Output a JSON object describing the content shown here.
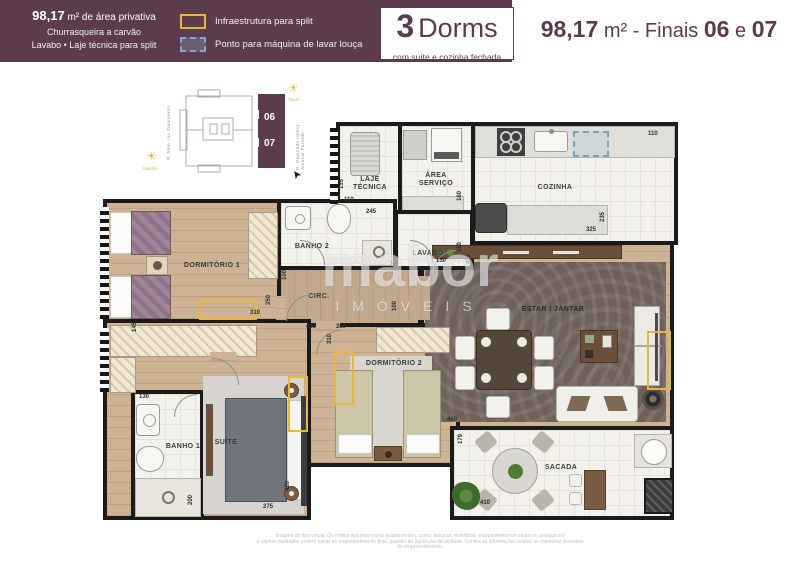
{
  "header": {
    "left": {
      "line1_bold": "98,17",
      "line1_rest": " m² de área privativa",
      "line2": "Churrasqueira a carvão",
      "line3": "Lavabo • Laje técnica para split"
    },
    "legend": [
      {
        "label": "Infraestrutura para split"
      },
      {
        "label": "Ponto para máquina de lavar louça"
      }
    ],
    "dorms_box": {
      "num": "3",
      "word": "Dorms",
      "sub": "com suíte e cozinha fechada"
    },
    "right": {
      "area": "98,17",
      "unit": "m²",
      "middle": " - Finais ",
      "final1": "06",
      "conj": " e ",
      "final2": "07"
    }
  },
  "key_diagram": {
    "unit_top": "06",
    "unit_bottom": "07",
    "sun_afternoon": "Tarde",
    "sun_morning": "Manhã",
    "street_left": "R. Mon. Ivo Zanlorenzi",
    "street_right": "R. Deputado Heitor Alencar Furtado"
  },
  "watermark": {
    "name": "mabor",
    "subtitle": "IMÓVEIS"
  },
  "plan": {
    "rooms": {
      "laje_l1": "LAJE",
      "laje_l2": "TÉCNICA",
      "area_l1": "ÁREA",
      "area_l2": "SERVIÇO",
      "cozinha": "COZINHA",
      "banho2": "BANHO 2",
      "lavabo": "LAVABO",
      "circ": "CIRC.",
      "dorm1": "DORMITÓRIO 1",
      "dorm2": "DORMITÓRIO 2",
      "suite": "SUÍTE",
      "banho1": "BANHO 1",
      "estar": "ESTAR / JANTAR",
      "sacada": "SACADA"
    },
    "dims": [
      "110",
      "155",
      "110",
      "245",
      "180",
      "235",
      "325",
      "110",
      "150",
      "425",
      "100",
      "100",
      "310",
      "250",
      "145",
      "420",
      "260",
      "310",
      "130",
      "200",
      "420",
      "275",
      "460",
      "179",
      "410"
    ]
  },
  "footer": {
    "line1": "Imagem do tipo virtual. Os estilos dos itens como acabamentos, cores, texturas, mobiliário, equipamentos decorativos, paisagismo",
    "line2": "e objetos ilustrados podem variar no empreendimento final, quando da aquisição da unidade. Confira as informações exatas no memorial descritivo do empreendimento."
  }
}
